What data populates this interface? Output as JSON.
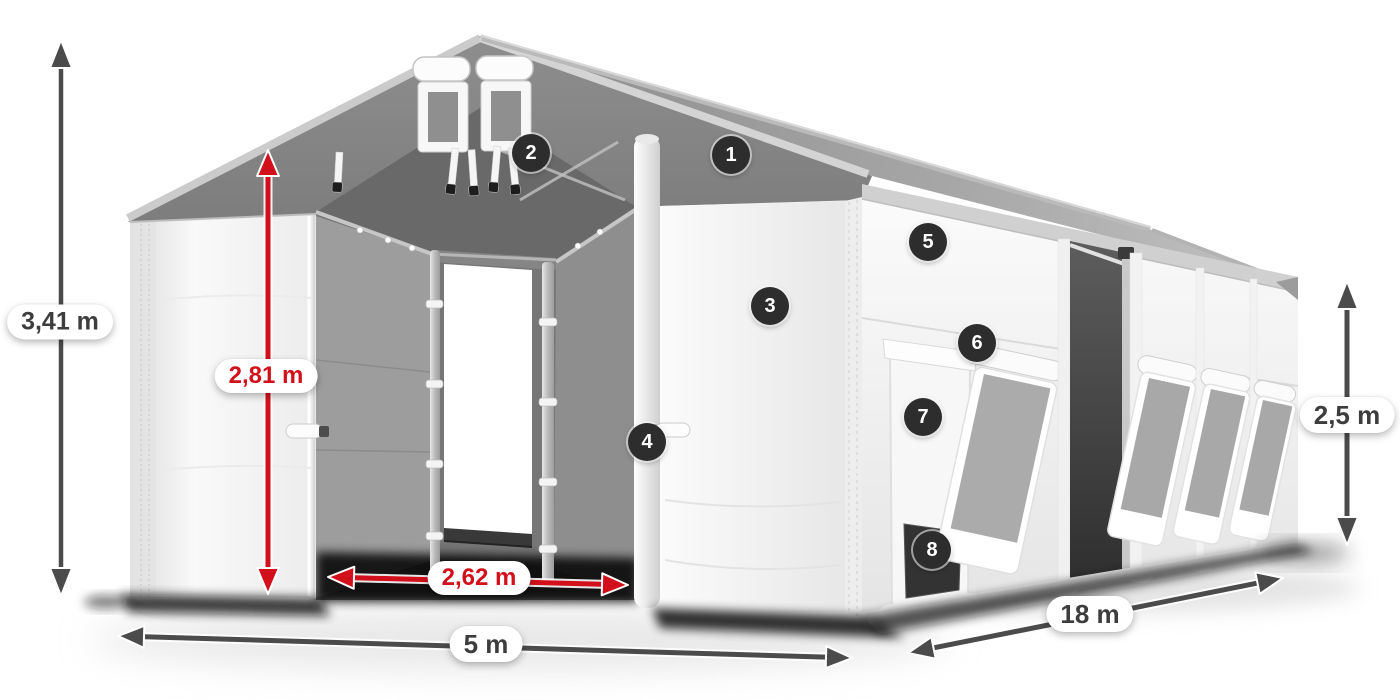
{
  "diagram": {
    "dimensions": {
      "total_height": "3,41 m",
      "entrance_height": "2,81 m",
      "entrance_width": "2,62 m",
      "width": "5 m",
      "length": "18 m",
      "side_height": "2,5 m"
    },
    "callouts": [
      "1",
      "2",
      "3",
      "4",
      "5",
      "6",
      "7",
      "8"
    ],
    "colors": {
      "accent_red": "#d2101c",
      "arrow_gray": "#4b4b4b",
      "badge_bg": "#2d2d2d",
      "label_text": "#3d3d3d",
      "roof_gray": "#8e8e8e"
    }
  }
}
